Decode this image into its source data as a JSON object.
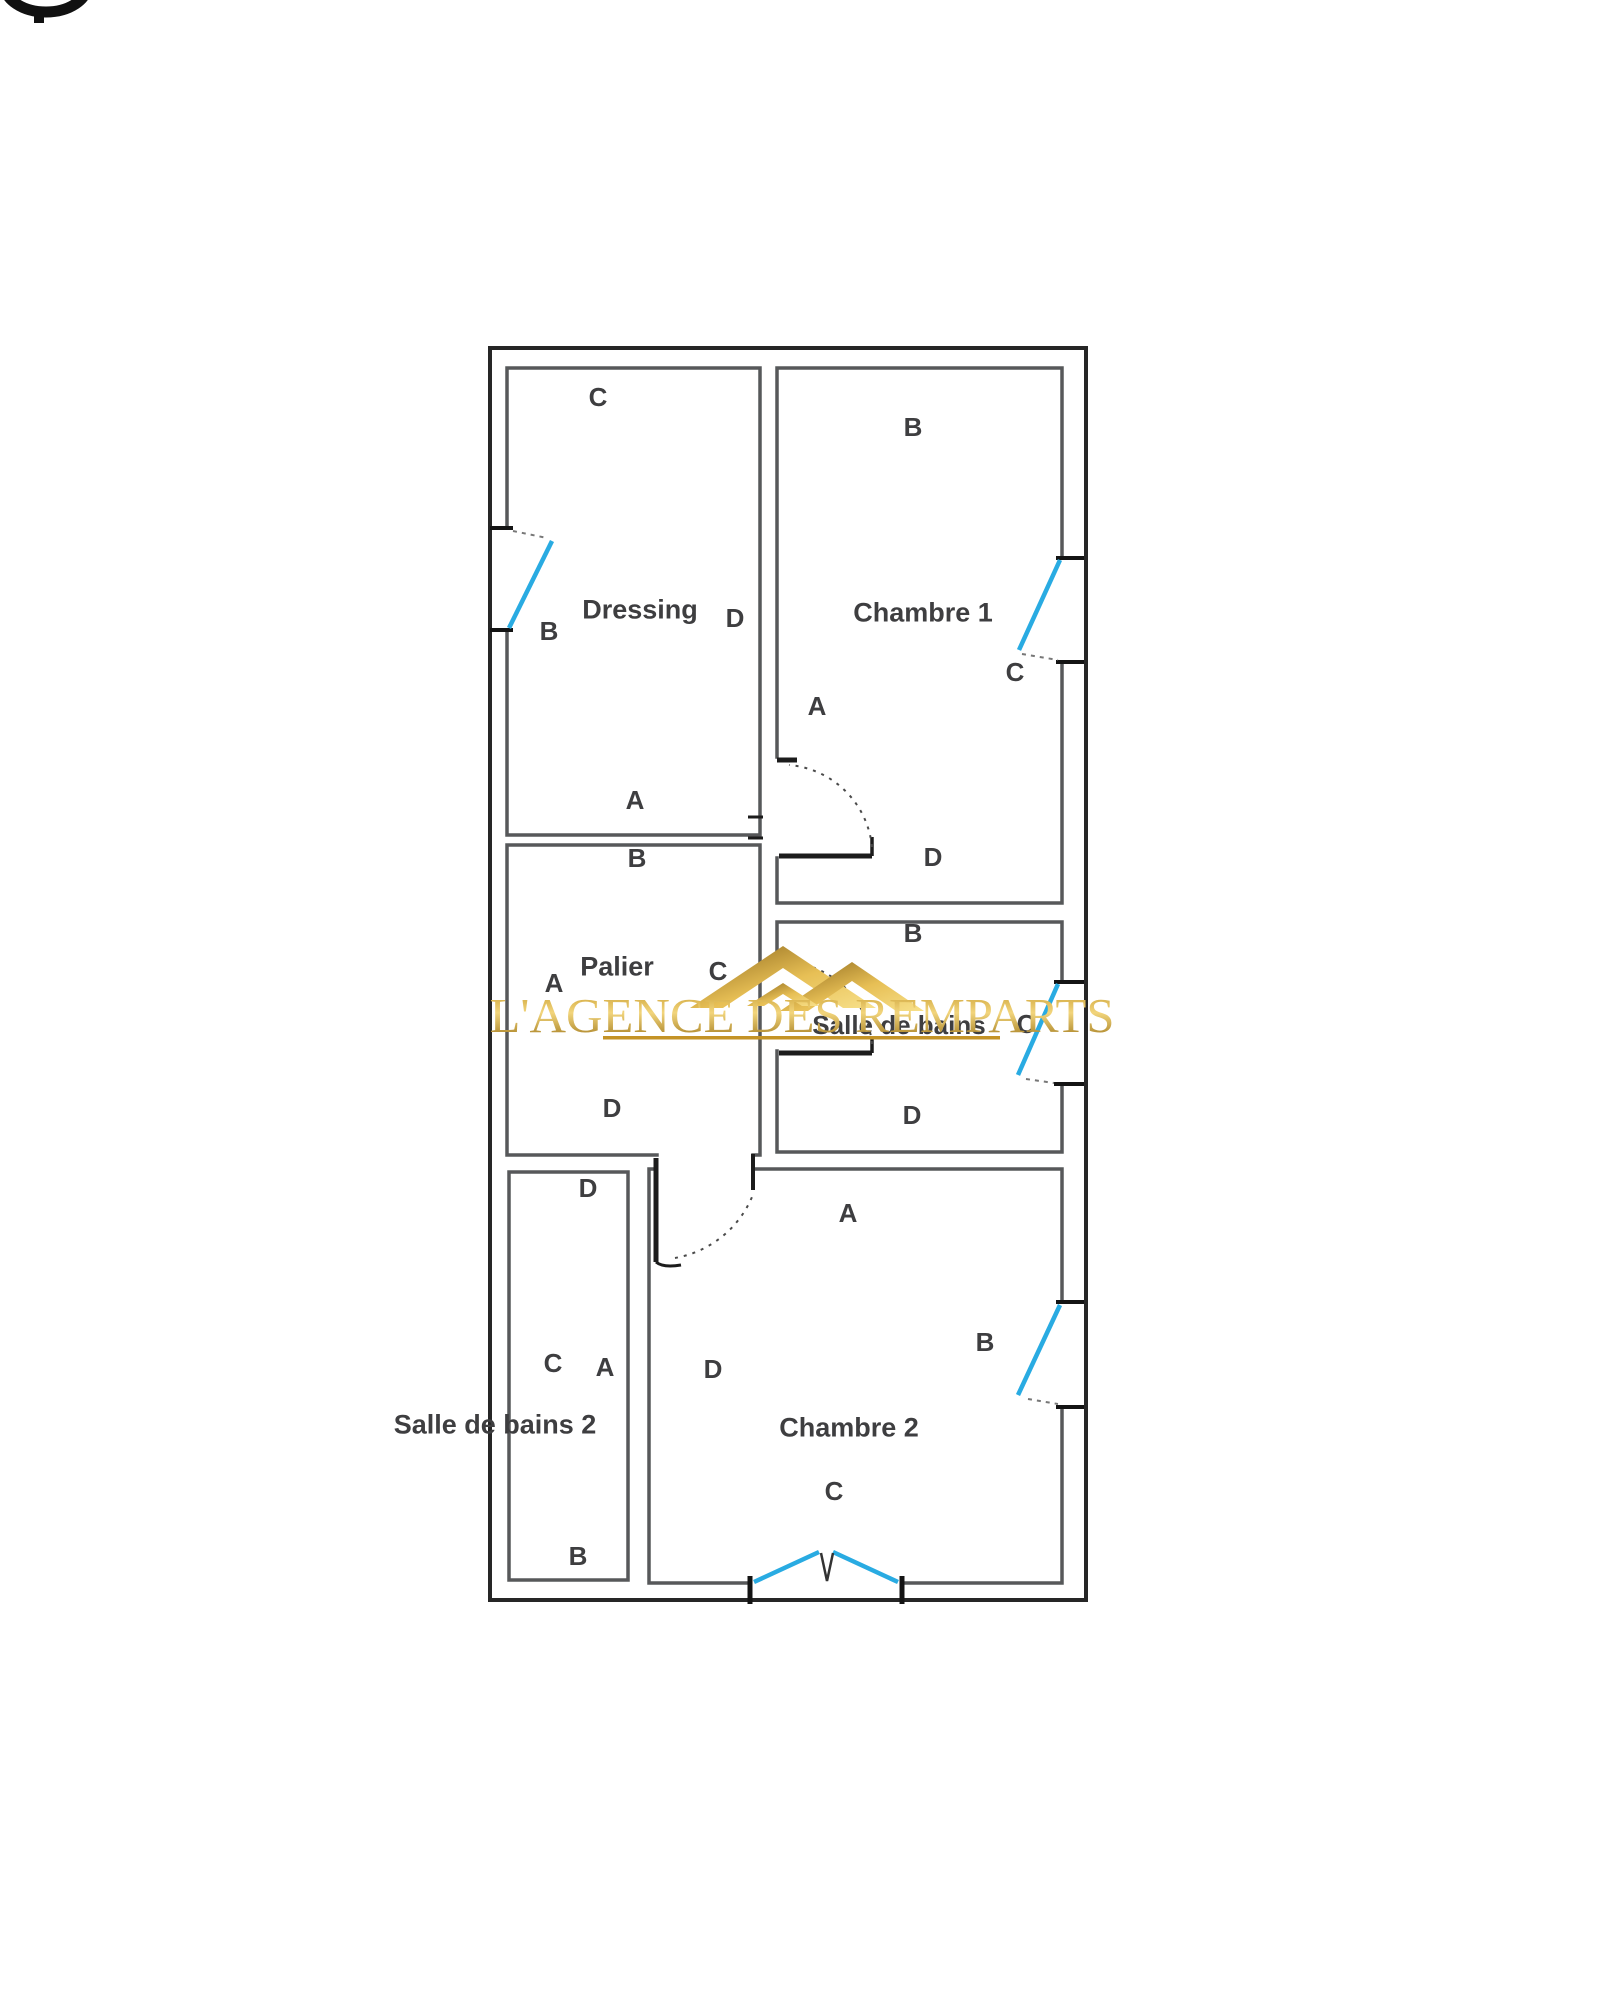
{
  "watermark": {
    "text": "L'AGENCE DES REMPARTS",
    "gold_color": "#C9971C"
  },
  "plan": {
    "window_color": "#29ABE2",
    "wall_color": "#57585A",
    "outer_wall_color": "#262626",
    "rooms": {
      "dressing": {
        "label": "Dressing",
        "letters": {
          "a": "A",
          "b": "B",
          "c": "C",
          "d": "D"
        }
      },
      "chambre1": {
        "label": "Chambre 1",
        "letters": {
          "a": "A",
          "b": "B",
          "c": "C",
          "d": "D"
        }
      },
      "palier": {
        "label": "Palier",
        "letters": {
          "a": "A",
          "b": "B",
          "c": "C",
          "d": "D"
        }
      },
      "salle_de_bains": {
        "label": "Salle de bains",
        "letters": {
          "b": "B",
          "c": "C",
          "d": "D"
        }
      },
      "salle_de_bains_2": {
        "label": "Salle de bains 2",
        "letters": {
          "a": "A",
          "b": "B",
          "c": "C",
          "d": "D"
        }
      },
      "chambre2": {
        "label": "Chambre 2",
        "letters": {
          "a": "A",
          "b": "B",
          "c": "C",
          "d": "D"
        }
      }
    }
  }
}
